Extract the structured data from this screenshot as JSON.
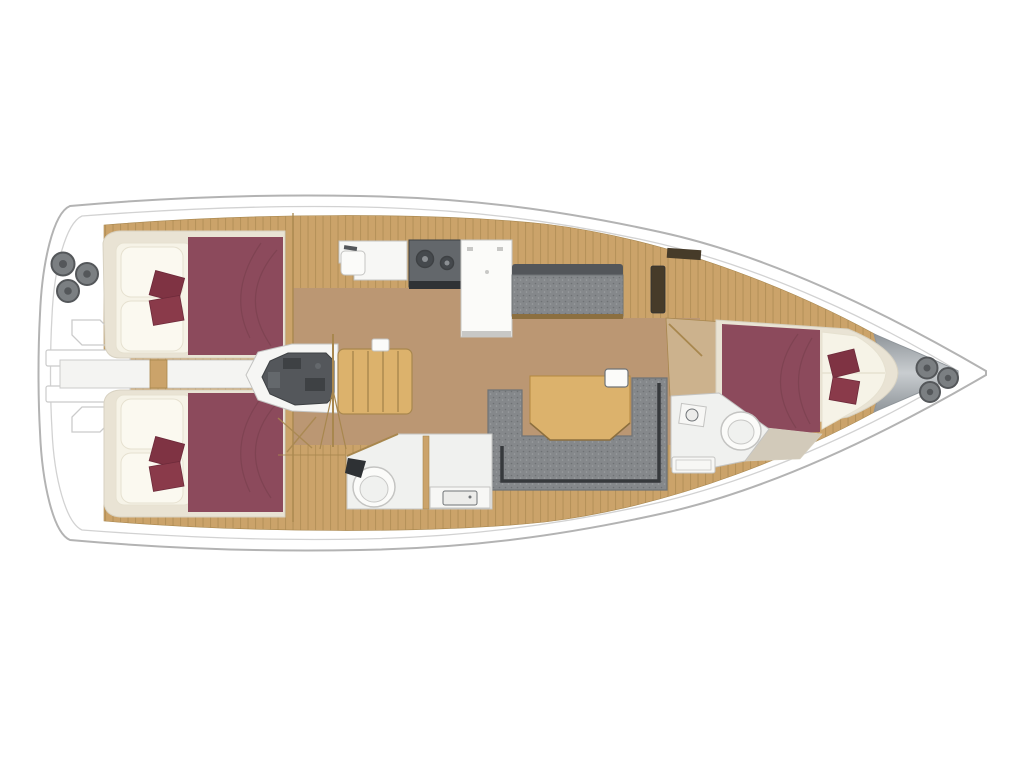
{
  "image": {
    "type": "sailing-yacht-interior-floor-plan",
    "orientation": "bow-right-stern-left"
  },
  "areas": [
    "transom-with-winches",
    "aft-cabin-starboard",
    "aft-cabin-port",
    "engine-compartment",
    "companionway-stairs",
    "galley",
    "refrigerator",
    "stove",
    "galley-sink",
    "starboard-settee",
    "u-shaped-settee",
    "saloon-table",
    "aft-head",
    "forward-head",
    "forward-cabin",
    "anchor-locker-with-windlass"
  ],
  "palette": {
    "background": "#ffffff",
    "hull_fill": "#ffffff",
    "hull_stroke": "#b3b3b3",
    "inner_stroke": "#d2d2d2",
    "transom_detail": "#cbcbcb",
    "deck_plank": "#cba36a",
    "deck_plank_line": "#a98750",
    "sole": "#bb9773",
    "entry_tan": "#ccb28d",
    "light_wood": "#dcb26c",
    "light_wood_stroke": "#b3883f",
    "wood_trim": "#a8874e",
    "wood_dark_line": "#8c6f3f",
    "beige": "#d2caba",
    "bed_frame": "#e9e3d4",
    "bed_frame_stroke": "#d8d2c2",
    "mattress": "#f6f3e7",
    "pillow": "#fbf9f0",
    "pillow_stroke": "#e6e1d0",
    "duvet": "#8c4a5c",
    "duvet_fold": "#79404f",
    "cushion_red": "#7f3343",
    "cushion_red2": "#8a3a4a",
    "cushion_stroke": "#6d2a3a",
    "settee_gray": "#85888b",
    "settee_speckle_dark": "#6e7174",
    "settee_speckle_light": "#9b9ea1",
    "settee_dark": "#53565a",
    "settee_trim": "#36393c",
    "settee_stroke": "#6f7376",
    "engine": "#54575b",
    "engine_dark": "#3e4144",
    "engine_light": "#64686c",
    "engine_bay": "#f6f6f4",
    "white_fixture": "#f7f7f5",
    "fixture_bright": "#fbfbf9",
    "head_floor": "#f0f1ef",
    "fixture_stroke": "#c4c4c2",
    "basin": "#ececea",
    "appliance": "#63676b",
    "appliance_dark": "#2f3235",
    "burner": "#45494d",
    "burner_ring": "#8b8f93",
    "winch": "#7b7f82",
    "winch_dark": "#54575a",
    "bow_gray_1": "#8f959a",
    "bow_gray_2": "#c9cdd0",
    "locker_slot": "#463b29",
    "dark_item": "#2e3134",
    "kick_plate": "#c8c8c6",
    "passage_white": "#f4f4f2"
  }
}
